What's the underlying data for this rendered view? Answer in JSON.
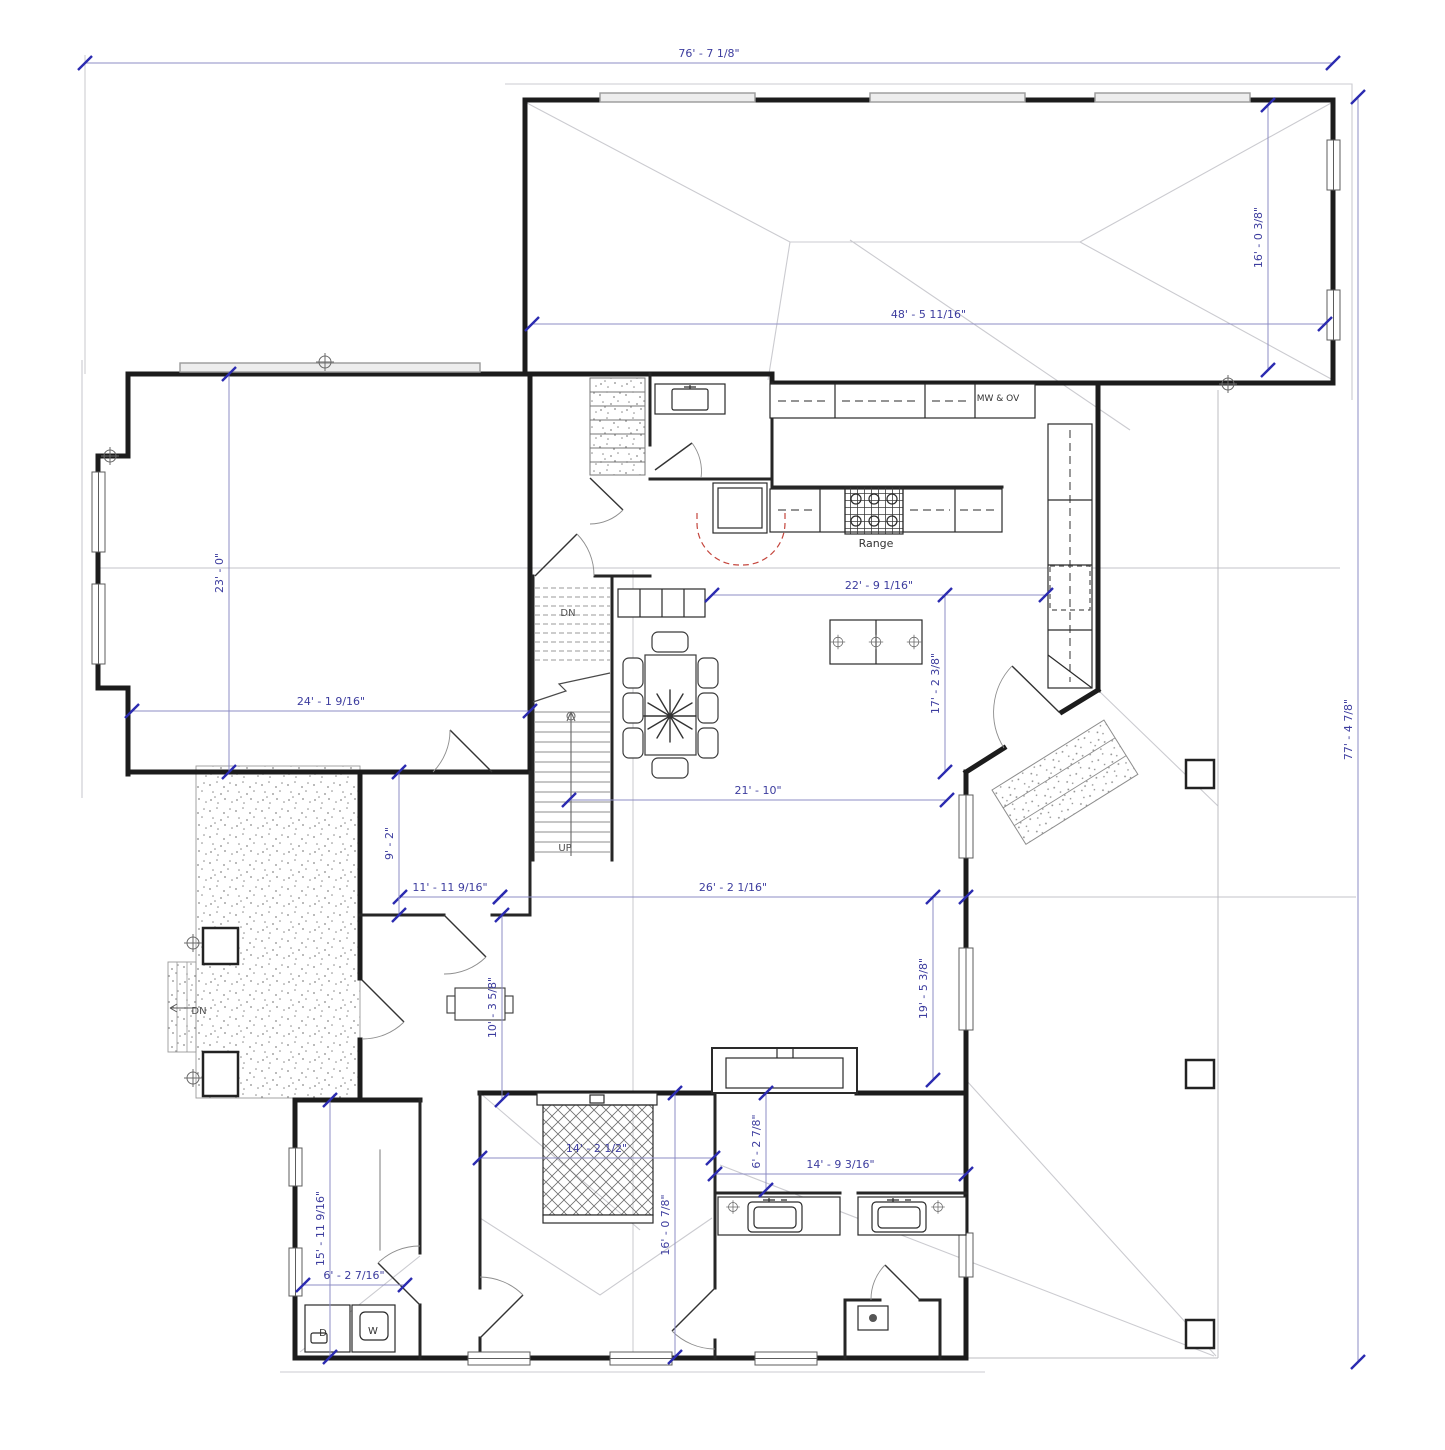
{
  "drawing": {
    "colors": {
      "dim_line": "#8c8cc4",
      "dim_tick": "#2b2bb0",
      "dim_text": "#3c3c9e",
      "wall": "#1c1c1c",
      "interior_wall": "#262626",
      "casework": "#2a2a2a",
      "roof_line": "#cbcbd0",
      "reference_line": "#c3c3c8",
      "clearance_red": "#c4453c",
      "label_dark": "#333333",
      "label_gray": "#4f4f4f"
    },
    "dimensions": [
      {
        "id": "overall-top",
        "text": "76' - 7 1/8\"",
        "orient": "h",
        "x1": 85,
        "x2": 1333,
        "y": 63
      },
      {
        "id": "overall-right",
        "text": "77' - 4 7/8\"",
        "orient": "v",
        "x": 1358,
        "y1": 97,
        "y2": 1362
      },
      {
        "id": "garage-depth",
        "text": "16' - 0 3/8\"",
        "orient": "v",
        "x": 1268,
        "y1": 105,
        "y2": 370
      },
      {
        "id": "garage-width",
        "text": "48' - 5 11/16\"",
        "orient": "h",
        "x1": 532,
        "x2": 1325,
        "y": 324
      },
      {
        "id": "left-room-height",
        "text": "23' - 0\"",
        "orient": "v",
        "x": 229,
        "y1": 374,
        "y2": 772
      },
      {
        "id": "left-room-width",
        "text": "24' - 1 9/16\"",
        "orient": "h",
        "x1": 132,
        "x2": 530,
        "y": 711
      },
      {
        "id": "kitchen-width",
        "text": "22' - 9 1/16\"",
        "orient": "h",
        "x1": 712,
        "x2": 1046,
        "y": 595
      },
      {
        "id": "kitchen-depth",
        "text": "17' - 2 3/8\"",
        "orient": "v",
        "x": 945,
        "y1": 595,
        "y2": 772
      },
      {
        "id": "great-room-width",
        "text": "21' - 10\"",
        "orient": "h",
        "x1": 569,
        "x2": 947,
        "y": 800
      },
      {
        "id": "hall-width",
        "text": "11' - 11 9/16\"",
        "orient": "h",
        "x1": 400,
        "x2": 500,
        "y": 897
      },
      {
        "id": "living-width",
        "text": "26' - 2 1/16\"",
        "orient": "h",
        "x1": 500,
        "x2": 966,
        "y": 897
      },
      {
        "id": "hall-height",
        "text": "9' - 2\"",
        "orient": "v",
        "x": 399,
        "y1": 772,
        "y2": 915
      },
      {
        "id": "porch-depth",
        "text": "10' - 3 5/8\"",
        "orient": "v",
        "x": 502,
        "y1": 915,
        "y2": 1100
      },
      {
        "id": "patio-depth",
        "text": "19' - 5 3/8\"",
        "orient": "v",
        "x": 933,
        "y1": 897,
        "y2": 1080
      },
      {
        "id": "laundry-height",
        "text": "15' - 11 9/16\"",
        "orient": "v",
        "x": 330,
        "y1": 1100,
        "y2": 1357
      },
      {
        "id": "laundry-width",
        "text": "6' - 2 7/16\"",
        "orient": "h",
        "x1": 303,
        "x2": 405,
        "y": 1285
      },
      {
        "id": "bedroom-width",
        "text": "14' - 2 1/2\"",
        "orient": "h",
        "x1": 480,
        "x2": 713,
        "y": 1158
      },
      {
        "id": "bedroom-height",
        "text": "16' - 0 7/8\"",
        "orient": "v",
        "x": 675,
        "y1": 1093,
        "y2": 1357
      },
      {
        "id": "bath-hall-height",
        "text": "6' - 2 7/8\"",
        "orient": "v",
        "x": 766,
        "y1": 1093,
        "y2": 1190
      },
      {
        "id": "bath-width",
        "text": "14' - 9 3/16\"",
        "orient": "h",
        "x1": 715,
        "x2": 966,
        "y": 1174
      }
    ],
    "labels": [
      {
        "id": "mw-ov",
        "text": "MW  & OV",
        "x": 998,
        "y": 401,
        "size": 9,
        "color": "#333333"
      },
      {
        "id": "range",
        "text": "Range",
        "x": 876,
        "y": 547,
        "size": 11,
        "color": "#333333"
      },
      {
        "id": "stairs-dn",
        "text": "DN",
        "x": 568,
        "y": 616,
        "size": 10,
        "color": "#4f4f4f"
      },
      {
        "id": "stairs-up",
        "text": "UP",
        "x": 565,
        "y": 851,
        "size": 10,
        "color": "#4f4f4f"
      },
      {
        "id": "patio-dn",
        "text": "DN",
        "x": 199,
        "y": 1014,
        "size": 10,
        "color": "#4f4f4f"
      },
      {
        "id": "dryer",
        "text": "D",
        "x": 323,
        "y": 1336,
        "size": 10,
        "color": "#333333"
      },
      {
        "id": "washer",
        "text": "W",
        "x": 373,
        "y": 1334,
        "size": 10,
        "color": "#333333"
      }
    ]
  }
}
